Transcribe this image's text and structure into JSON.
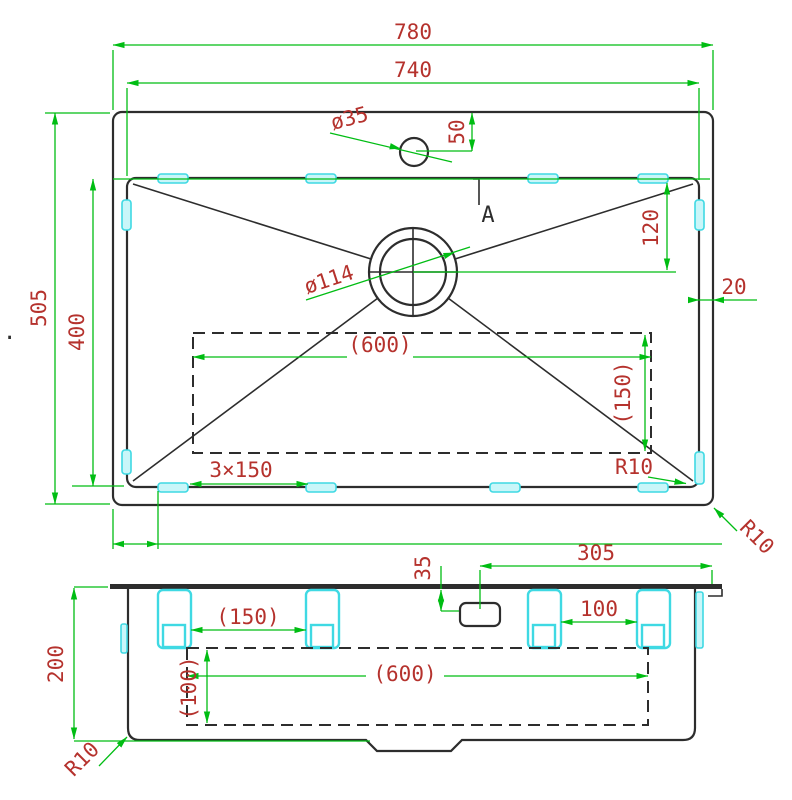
{
  "drawing_type": "sink-technical-drawing",
  "colors": {
    "dimension_line": "#00bd13",
    "dimension_text": "#b5322d",
    "outline": "#2d2d2d",
    "mounting_clip": "#3fd9e3",
    "background": "#ffffff"
  },
  "top_view": {
    "overall_width": "780",
    "bowl_width": "740",
    "overall_depth": "505",
    "bowl_depth": "400",
    "faucet_offset": "50",
    "faucet_diameter": "ø35",
    "drain_diameter": "ø114",
    "drain_offset": "120",
    "rim_gap": "20",
    "cutout_width": "(600)",
    "cutout_depth": "(150)",
    "clip_pitch": "3×150",
    "inner_corner_radius": "R10",
    "outer_corner_radius": "R10",
    "section_mark": "A"
  },
  "front_view": {
    "height": "200",
    "hole_offset_top": "35",
    "hole_offset_right": "305",
    "clip_gap_left": "(150)",
    "clip_gap_right": "100",
    "cutout_width": "(600)",
    "cutout_height": "(100)",
    "corner_radius": "R10"
  },
  "artifact_dot": "."
}
